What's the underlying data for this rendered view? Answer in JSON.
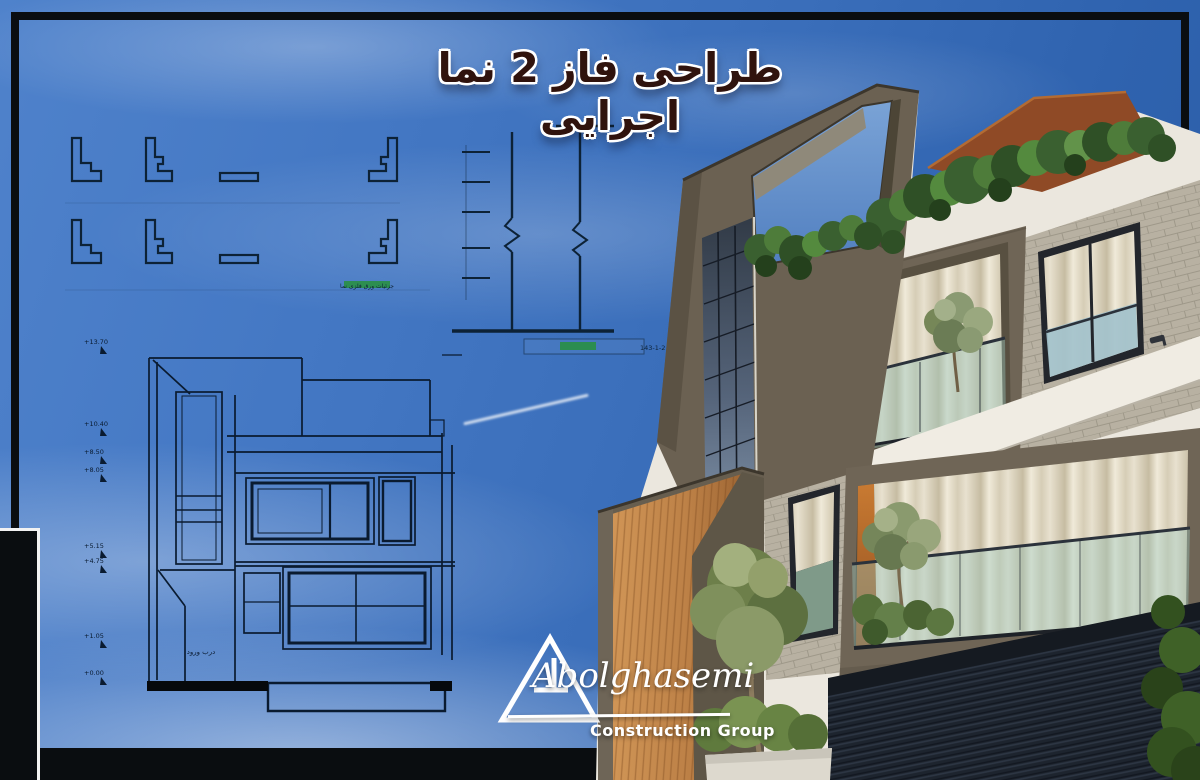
{
  "poster": {
    "title": "طراحی فاز 2 نما اجرایی"
  },
  "logo": {
    "name": "Abolghasemi",
    "subtitle": "Construction Group"
  },
  "drawings": {
    "elevation": {
      "door_label": "درب ورود",
      "levels": [
        "+13.70",
        "+10.40",
        "+8.50",
        "+8.05",
        "+5.15",
        "+4.75",
        "+1.05",
        "+0.00"
      ]
    },
    "section": {
      "caption": "پیوست نما اصلی 2-1-143"
    },
    "details": {
      "caption": "جزئیات ورق فلزی نما"
    }
  },
  "colors": {
    "sky_top": "#4f82cb",
    "sky_deep": "#2b5ca6",
    "frame": "#0a0d10",
    "blueprint_line": "#0a1b30",
    "taupe_wall": "#6b6152",
    "white_band": "#ece8df",
    "wood": "#c08a4f",
    "rust_corten": "#8f4a26",
    "foliage": "#3f6b2f",
    "accent_orange": "#b06a2e",
    "title_color": "#30130d",
    "highlight_green": "#27903c"
  }
}
